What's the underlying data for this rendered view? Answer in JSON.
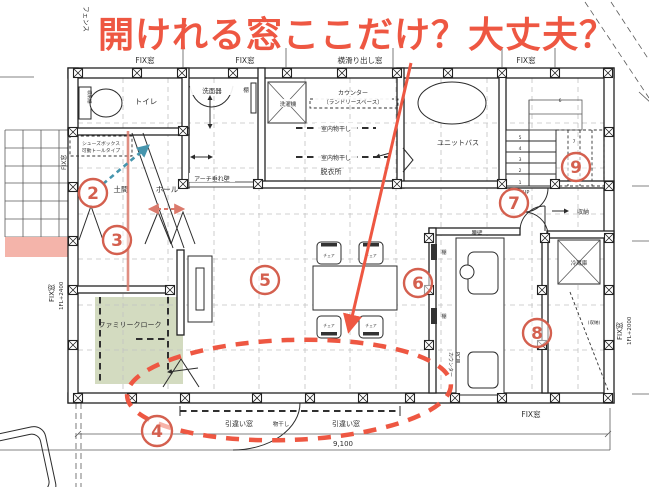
{
  "annotations": {
    "headline": "開けれる窓ここだけ？大丈夫？",
    "circled_numbers": [
      "2",
      "3",
      "4",
      "5",
      "6",
      "7",
      "8",
      "9"
    ]
  },
  "windows": {
    "fence": "フェンス",
    "top_fix_1": "FIX窓",
    "top_fix_2": "FIX窓",
    "top_awning": "横滑り出し窓",
    "top_fix_3": "FIX窓",
    "left_fix": "FIX窓",
    "left_fix_height": "1FL+2400",
    "right_fix": "FIX窓",
    "right_fix_height": "1FL+2000",
    "bottom_fix": "FIX窓",
    "sliding_1": "引違い窓",
    "monohoshi": "物干し",
    "sliding_2": "引違い窓"
  },
  "rooms": {
    "toilet": "トイレ",
    "toilet_storage": "収納棚",
    "shoes_box_line1": "シューズボックス",
    "shoes_box_line2": "可動トールタイプ",
    "doma": "土間",
    "hall": "ホール",
    "arch_wall": "アーチ垂れ壁",
    "washbasin": "洗面器",
    "shelf": "棚",
    "washer": "洗濯機",
    "counter_line1": "カウンター",
    "counter_line2": "（ランドリースペース）",
    "indoor_drying_1": "室内物干し",
    "indoor_drying_2": "室内物干し",
    "dressing_room": "脱衣所",
    "unit_bath": "ユニットバス",
    "closet": "収納",
    "family_cloak": "ファミリークローク",
    "dining_table": "ダイニングテーブル",
    "chair": "チェア",
    "half_wall": "腰壁",
    "kitchen_shelf_1": "棚",
    "kitchen_shelf_2": "棚",
    "fridge": "冷蔵庫",
    "pantry": "(収納)",
    "pc_counter_line1": "PC用",
    "pc_counter_line2": "カウンター",
    "up": "UP"
  },
  "stairs": {
    "numbers": [
      "1",
      "2",
      "3",
      "4",
      "5",
      "6",
      "7"
    ]
  },
  "dimensions": {
    "width": "9,100"
  },
  "colors": {
    "annotation_red": "#ee5742",
    "circle_red": "#d4604f",
    "salmon": "#db7a6c",
    "teal": "#4695ad",
    "zone_green": "#cbd5b5",
    "zone_pink": "#f4b4aa"
  }
}
